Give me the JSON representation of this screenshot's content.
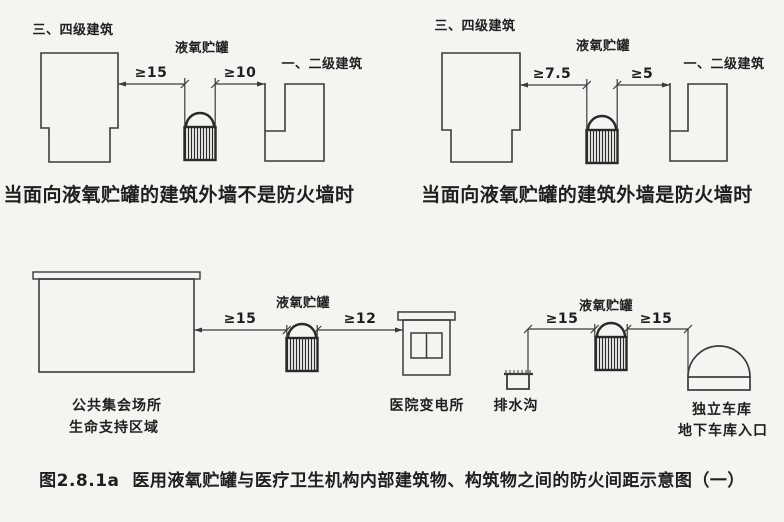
{
  "colors": {
    "background": "#f4f4f1",
    "line": "#3b3b3b",
    "tank_line": "#2a2a2a",
    "text": "#1f1f1f"
  },
  "diagrams": {
    "top_left": {
      "building_left_label": "三、四级建筑",
      "tank_label": "液氧贮罐",
      "building_right_label": "一、二级建筑",
      "dim_left": "≥15",
      "dim_right": "≥10",
      "caption": "当面向液氧贮罐的建筑外墙不是防火墙时"
    },
    "top_right": {
      "building_left_label": "三、四级建筑",
      "tank_label": "液氧贮罐",
      "building_right_label": "一、二级建筑",
      "dim_left": "≥7.5",
      "dim_right": "≥5",
      "caption": "当面向液氧贮罐的建筑外墙是防火墙时"
    },
    "bottom_left": {
      "building_label_line1": "公共集会场所",
      "building_label_line2": "生命支持区域",
      "tank_label": "液氧贮罐",
      "substation_label": "医院变电所",
      "dim_left": "≥15",
      "dim_right": "≥12"
    },
    "bottom_right": {
      "ditch_label": "排水沟",
      "tank_label": "液氧贮罐",
      "garage_label_line1": "独立车库",
      "garage_label_line2": "地下车库入口",
      "dim_left": "≥15",
      "dim_right": "≥15"
    }
  },
  "figure_caption": "图2.8.1a  医用液氧贮罐与医疗卫生机构内部建筑物、构筑物之间的防火间距示意图（一）"
}
